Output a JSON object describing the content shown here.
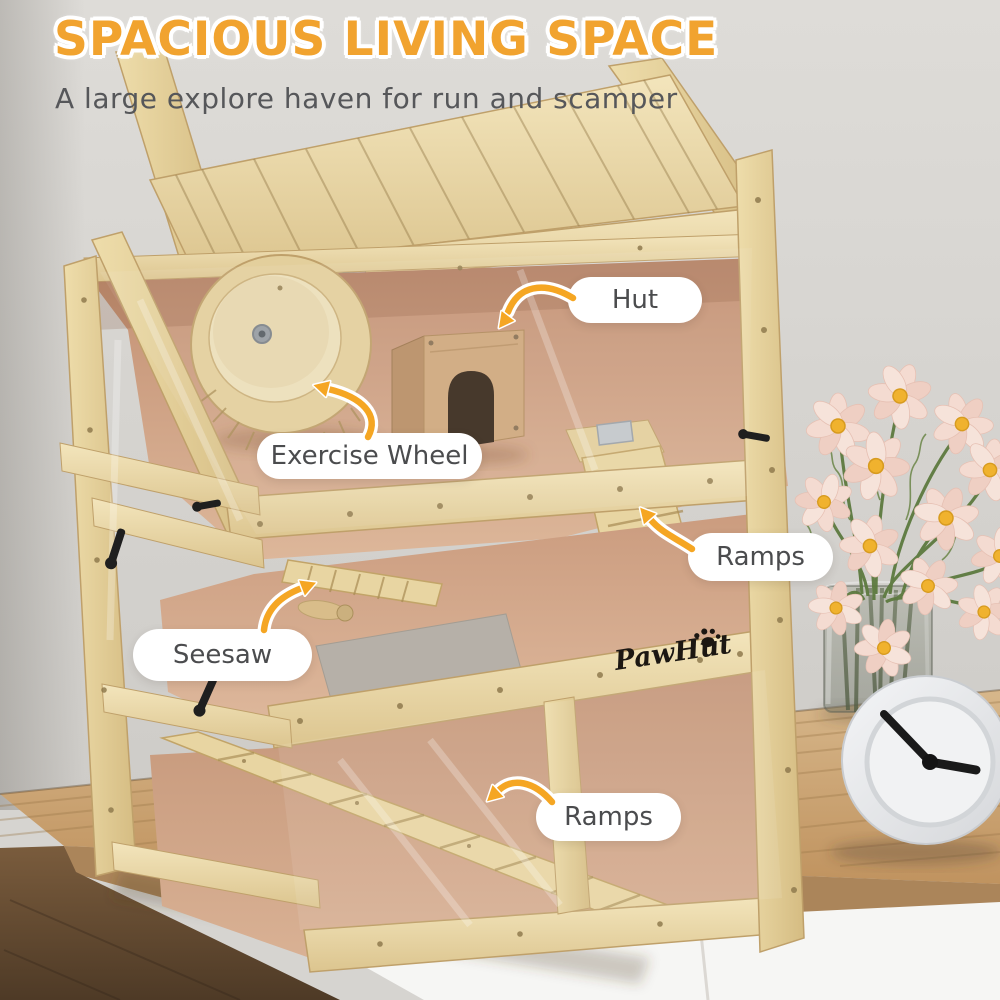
{
  "header": {
    "title": "SPACIOUS LIVING SPACE",
    "subtitle": "A large explore haven for run and scamper"
  },
  "callouts": {
    "hut": "Hut",
    "exercise_wheel": "Exercise Wheel",
    "ramps_upper": "Ramps",
    "seesaw": "Seesaw",
    "ramps_lower": "Ramps"
  },
  "brand": {
    "logo_text": "PawHut"
  },
  "colors": {
    "title_orange": "#F1A32F",
    "arrow_orange": "#F5A623",
    "callout_text": "#4B4C4E",
    "subtitle_gray": "#56575A",
    "wood_light": "#EBD8A6",
    "fleece_pink": "#D7AC90"
  }
}
